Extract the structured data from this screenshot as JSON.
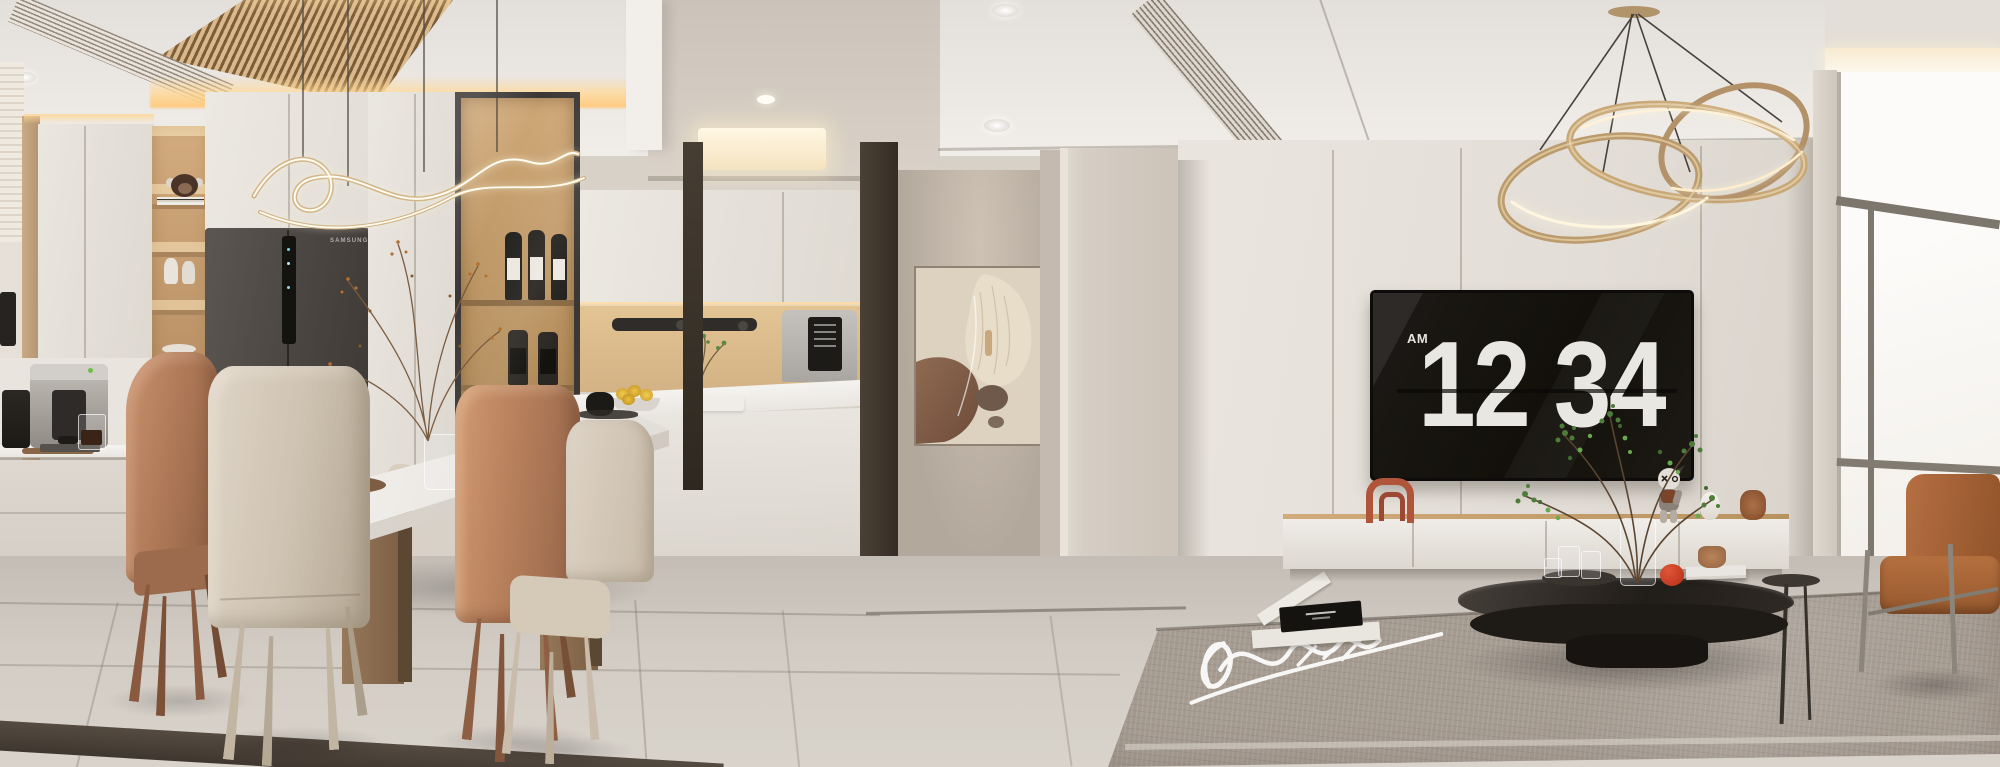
{
  "scene": {
    "description": "Photorealistic 3D render of a modern beige apartment: kitchen and dining area on the left, entry hallway in the center, living room with TV wall, flip-clock screen and window on the right.",
    "rooms": [
      "kitchen",
      "dining-area",
      "hallway",
      "living-room"
    ]
  },
  "tv_clock": {
    "meridiem": "AM",
    "hours": "12",
    "minutes": "34"
  },
  "fridge": {
    "brand": "SAMSUNG"
  },
  "palette": {
    "ceiling": "#eeebe7",
    "walls": "#d9d2c9",
    "cabinet_white": "#e9e5df",
    "wood": "#c89e6e",
    "fridge_body": "#4c4844",
    "tv_screen": "#14110e",
    "clock_digits": "#eae8e3",
    "terracotta_chair": "#b37a57",
    "cream_chair": "#d6ccbd",
    "floor": "#cbc5bd",
    "carpet": "#a2988e",
    "gold_light": "#c9a876",
    "coffee_table": "#26211c",
    "lounge_chair": "#a9653a"
  }
}
